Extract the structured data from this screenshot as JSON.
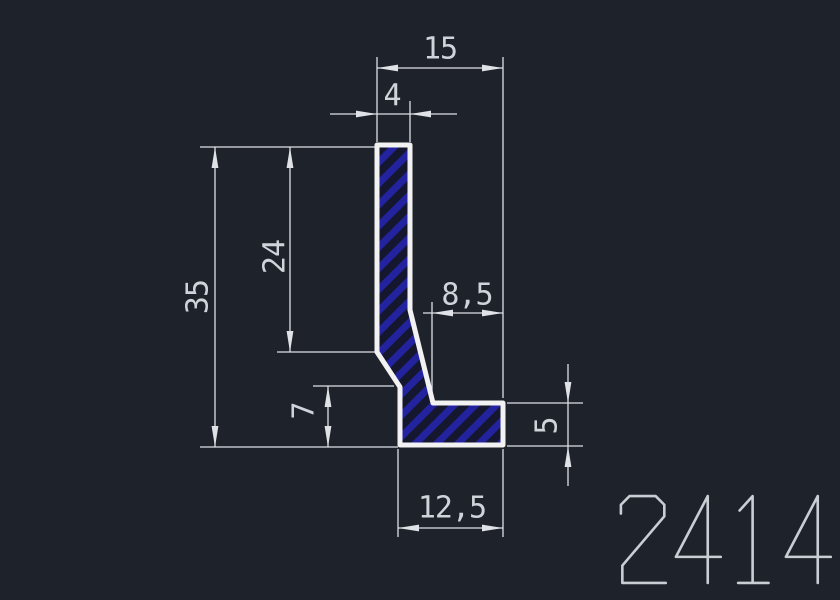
{
  "title": "profile-cross-section-drawing",
  "part_number": {
    "text": "2414"
  },
  "dims": {
    "d15": {
      "label": "15"
    },
    "d4": {
      "label": "4"
    },
    "d35": {
      "label": "35"
    },
    "d24": {
      "label": "24"
    },
    "d85": {
      "label": "8,5"
    },
    "d7": {
      "label": "7"
    },
    "d5": {
      "label": "5"
    },
    "d125": {
      "label": "12,5"
    }
  },
  "colors": {
    "background": "#1e232b",
    "dimension_lines": "#dde1e6",
    "dimension_text": "#cfd4da",
    "profile_outline": "#f2f2f2",
    "hatch_stripes": "#2323a0",
    "hatch_background": "#14172e",
    "part_number_text": "#c9ced4"
  }
}
